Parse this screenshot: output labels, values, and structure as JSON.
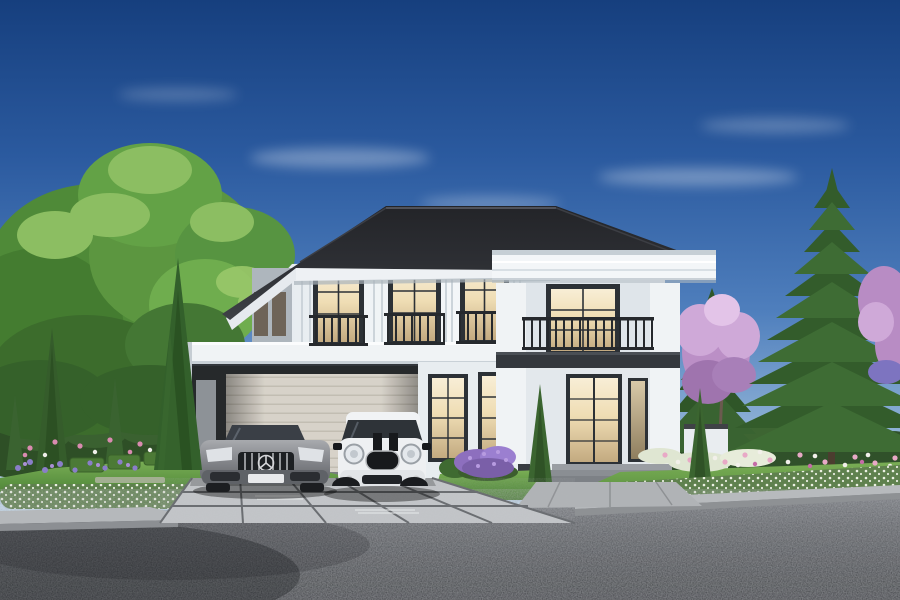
{
  "scene": {
    "type": "photorealistic architectural exterior rendering",
    "subject": "luxury two-story detached house, white modern-colonial facade with dark hip roof",
    "setting": "landscaped front garden, paver driveway, asphalt road in foreground, clear blue sky",
    "lighting": "daylight with warm interior lights glowing in every window",
    "visible_text": "none"
  },
  "palette": {
    "sky-top": "#163F7E",
    "sky-mid": "#4F7FBD",
    "sky-horizon": "#DFEDF7",
    "roof-dark": "#26272B",
    "wall-white": "#F2F5F7",
    "trim-dark": "#33373C",
    "window-frame": "#2C3136",
    "window-glow": "#F2E3C0",
    "railing-iron": "#26292D",
    "garage-door-beige": "#D7D2C9",
    "lawn-green": "#5A9140",
    "hedge-green": "#31552A",
    "pine-green": "#3A6632",
    "tree-green": "#5C9640",
    "blossom-pink": "#BB8FC6",
    "flower-pink": "#E8A9C6",
    "flower-purple": "#8A7EC9",
    "road-asphalt": "#46494E",
    "curb-concrete": "#B5B8BB",
    "paver-gray": "#C3C6C9",
    "car-sedan-silver": "#8F9094",
    "car-suv-white": "#EEF0F2"
  },
  "house": {
    "stories": 2,
    "roof": "dark gray hipped roof with wide eaves and white fascia",
    "facade": "white walls with grooved pilasters and dark window casings",
    "upper_floor": {
      "tall_windows": 4,
      "juliet_balconies": 3,
      "balcony_over_entrance": 1
    },
    "entrance_bay": {
      "cornice": "white entablature",
      "french_doors": 1,
      "steps": 3
    },
    "carport": {
      "bays": 2,
      "rear_door": "beige sectional garage door",
      "flat_roof": "white parapet with dark underside"
    }
  },
  "vehicles": [
    {
      "name": "silver-sedan",
      "description": "gray sport sedan, vertical-slat black grille with round star emblem, parked under carport"
    },
    {
      "name": "white-suv",
      "description": "white compact SUV with black hood stripes, round headlights, black grille, parked under carport"
    }
  ],
  "landscape": {
    "left": "large deciduous tree, columnar cypresses, dark shrub wall, purple and pink flower bed, trimmed box hedges, lawn",
    "right": "two tall Norfolk-pine style conifers, pink blossom trees, mixed pink-white flower beds, lawn",
    "front": "white-flowering low hedges along concrete curb, large-paver driveway, gray walkway, dark asphalt road"
  }
}
